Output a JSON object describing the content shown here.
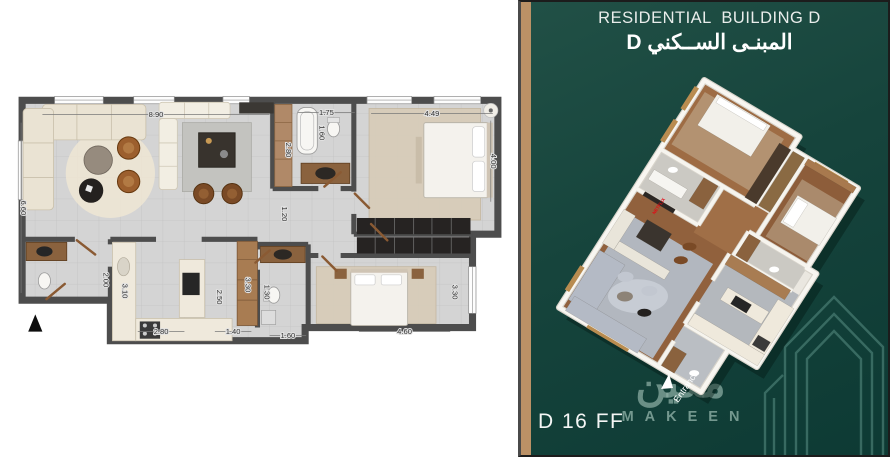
{
  "left_panel": {
    "dims": {
      "living_width": "8.90",
      "bath1_width": "1.75",
      "bedroom1_width": "4.49",
      "living_height": "6.60",
      "bedroom1_height": "4.00",
      "wardrobe_height": "2.80",
      "tub_length": "1.60",
      "hall_height": "1.20",
      "kitchen_entry": "2.00",
      "kitchen_height": "3.10",
      "kitchen_width": "2.80",
      "island_height": "2.50",
      "pantry_height": "3.30",
      "pantry_width": "1.40",
      "bath2_height": "1.30",
      "bath2_width": "1.60",
      "bedroom2_width": "4.60",
      "bedroom2_height": "3.30"
    }
  },
  "right_panel": {
    "title_en": "RESIDENTIAL  BUILDING D",
    "title_ar": "المبنـى الســكني D",
    "unit_label": "D 16 FF",
    "entrance_label": "Entrance",
    "tv_brand": "NETFLIX",
    "brand_ar": "مكين",
    "brand_en": "MAKEEN",
    "colors": {
      "panel_green": "#123f38",
      "accent_gold": "#bb9166",
      "watermark_green": "#8dafa5"
    }
  }
}
